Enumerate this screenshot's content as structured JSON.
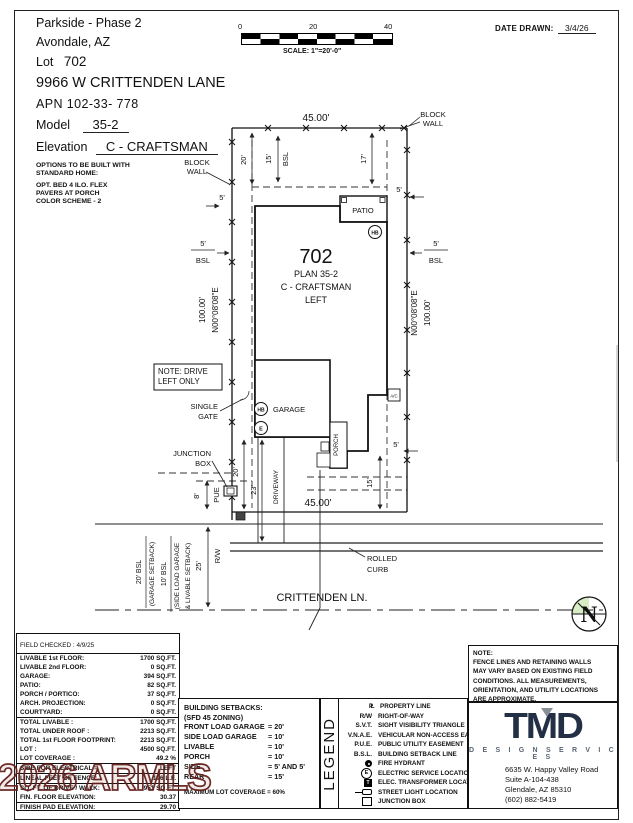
{
  "header": {
    "line1": "Parkside - Phase 2",
    "line2": "Avondale, AZ",
    "lot_label": "Lot",
    "lot_value": "702",
    "address": "9966 W CRITTENDEN LANE",
    "apn": "APN 102-33- 778",
    "model_label": "Model",
    "model_value": "35-2",
    "elevation_label": "Elevation",
    "elevation_value": "C - CRAFTSMAN",
    "options": [
      "OPTIONS TO BE BUILT WITH",
      "STANDARD HOME:",
      "OPT. BED 4 ILO. FLEX",
      "PAVERS AT PORCH",
      "COLOR SCHEME - 2"
    ]
  },
  "scale_bar": {
    "labels": [
      "0",
      "20",
      "40"
    ],
    "caption": "SCALE: 1\"=20'-0\""
  },
  "date_drawn": {
    "label": "DATE DRAWN:",
    "value": "3/4/26"
  },
  "plan": {
    "top_width": "45.00'",
    "bottom_width": "45.00'",
    "block_wall_line1": "BLOCK",
    "block_wall_line2": "WALL",
    "lot_number": "702",
    "plan_name": "PLAN 35-2",
    "elevation": "C - CRAFTSMAN",
    "orientation": "LEFT",
    "dist100": "100.00'",
    "bearing": "N00°08'08\"E",
    "d20": "20'",
    "d15": "15'",
    "d17": "17'",
    "d5": "5'",
    "d8": "8'",
    "d23": "23'",
    "d25": "25'",
    "bsl": "BSL",
    "pue": "PUE",
    "rw": "R/W",
    "patio": "PATIO",
    "garage": "GARAGE",
    "porch": "PORCH",
    "ac": "A/C",
    "hb": "HB",
    "e": "E",
    "note_drive1": "NOTE: DRIVE",
    "note_drive2": "LEFT ONLY",
    "single_gate1": "SINGLE",
    "single_gate2": "GATE",
    "junction1": "JUNCTION",
    "junction2": "BOX",
    "driveway": "DRIVEWAY",
    "rolled_curb1": "ROLLED",
    "rolled_curb2": "CURB",
    "street": "CRITTENDEN LN.",
    "setback_left_a": "20' BSL",
    "setback_left_b": "(GARAGE SETBACK)",
    "setback_left_c": "10' BSL",
    "setback_left_d": "(SIDE LOAD GARAGE",
    "setback_left_e": "& LIVABLE SETBACK)",
    "north": "N"
  },
  "area": {
    "field_checked": "FIELD CHECKED : 4/9/25",
    "rows": [
      {
        "label": "LIVABLE 1st FLOOR:",
        "value": "1700 SQ.FT."
      },
      {
        "label": "LIVABLE 2nd FLOOR:",
        "value": "0 SQ.FT."
      },
      {
        "label": "GARAGE:",
        "value": "394 SQ.FT."
      },
      {
        "label": "PATIO:",
        "value": "82 SQ.FT."
      },
      {
        "label": "PORCH / PORTICO:",
        "value": "37 SQ.FT."
      },
      {
        "label": "ARCH. PROJECTION:",
        "value": "0 SQ.FT."
      },
      {
        "label": "COURTYARD:",
        "value": "0 SQ.FT."
      }
    ],
    "totals": [
      {
        "label": "TOTAL LIVABLE :",
        "value": "1700 SQ.FT."
      },
      {
        "label": "TOTAL UNDER ROOF :",
        "value": "2213 SQ.FT."
      },
      {
        "label": "TOTAL 1st FLOOR FOOTPRINT:",
        "value": "2213 SQ.FT."
      },
      {
        "label": "LOT :",
        "value": "4500 SQ.FT."
      },
      {
        "label": "LOT COVERAGE :",
        "value": "49.2 %"
      }
    ],
    "electrical": {
      "label": "SIDE FOR ELECTRICAL =",
      "value": "LEFT"
    },
    "fence": {
      "label": "LINEAL FEET OF FENCE:",
      "value": "196 L.F."
    },
    "drive": {
      "label": "SQ. FT. OF DRIVE / WALK:",
      "value": "951 SQ.FT."
    },
    "floor_elev": {
      "label": "FIN. FLOOR ELEVATION:",
      "value": "30.37"
    },
    "pad": {
      "label": "FINISH PAD ELEVATION:",
      "value": "29.70"
    }
  },
  "setbacks": {
    "title1": "BUILDING SETBACKS:",
    "title2": "(SFD 45 ZONING)",
    "rows": [
      {
        "label": "FRONT LOAD GARAGE",
        "value": "= 20'"
      },
      {
        "label": "SIDE LOAD GARAGE",
        "value": "= 10'"
      },
      {
        "label": "LIVABLE",
        "value": "= 10'"
      },
      {
        "label": "PORCH",
        "value": "= 10'"
      },
      {
        "label": "SIDE",
        "value": "= 5' AND 5'"
      },
      {
        "label": "REAR",
        "value": "= 15'"
      }
    ],
    "footer": "MAXIMUM LOT COVERAGE = 60%"
  },
  "legend": {
    "title": "LEGEND",
    "rows": [
      {
        "sym": "PL",
        "label": "PROPERTY LINE"
      },
      {
        "sym": "R/W",
        "label": "RIGHT-OF-WAY"
      },
      {
        "sym": "S.V.T.",
        "label": "SIGHT VISIBILITY TRIANGLE"
      },
      {
        "sym": "V.N.A.E.",
        "label": "VEHICULAR NON-ACCESS EASE."
      },
      {
        "sym": "P.U.E.",
        "label": "PUBLIC UTILITY EASEMENT"
      },
      {
        "sym": "B.S.L.",
        "label": "BUILDING SETBACK LINE"
      },
      {
        "sym": "",
        "label": "FIRE HYDRANT"
      },
      {
        "sym": "E",
        "label": "ELECTRIC SERVICE LOCATION"
      },
      {
        "sym": "T",
        "label": "ELEC. TRANSFORMER LOCATION"
      },
      {
        "sym": "",
        "label": "STREET LIGHT LOCATION"
      },
      {
        "sym": "",
        "label": "JUNCTION BOX"
      }
    ]
  },
  "note": {
    "title": "NOTE:",
    "lines": [
      "FENCE LINES AND RETAINING WALLS",
      "MAY VARY BASED ON EXISTING FIELD",
      "CONDITIONS.  ALL MEASUREMENTS,",
      "ORIENTATION, AND UTILITY LOCATIONS",
      "ARE APPROXIMATE."
    ]
  },
  "tmd": {
    "logo": "TMD",
    "tagline": "D E S I G N   S E R V I C E S",
    "address1": "6635 W. Happy Valley Road",
    "address2": "Suite A-104-438",
    "address3": "Glendale, AZ 85310",
    "phone": "(602) 882-5419"
  },
  "watermark": {
    "text": "2026 ARMLS"
  },
  "colors": {
    "ink": "#111111",
    "tmd_navy": "#232f45",
    "north_green": "#d8ecc5",
    "watermark_red": "#64201c"
  }
}
